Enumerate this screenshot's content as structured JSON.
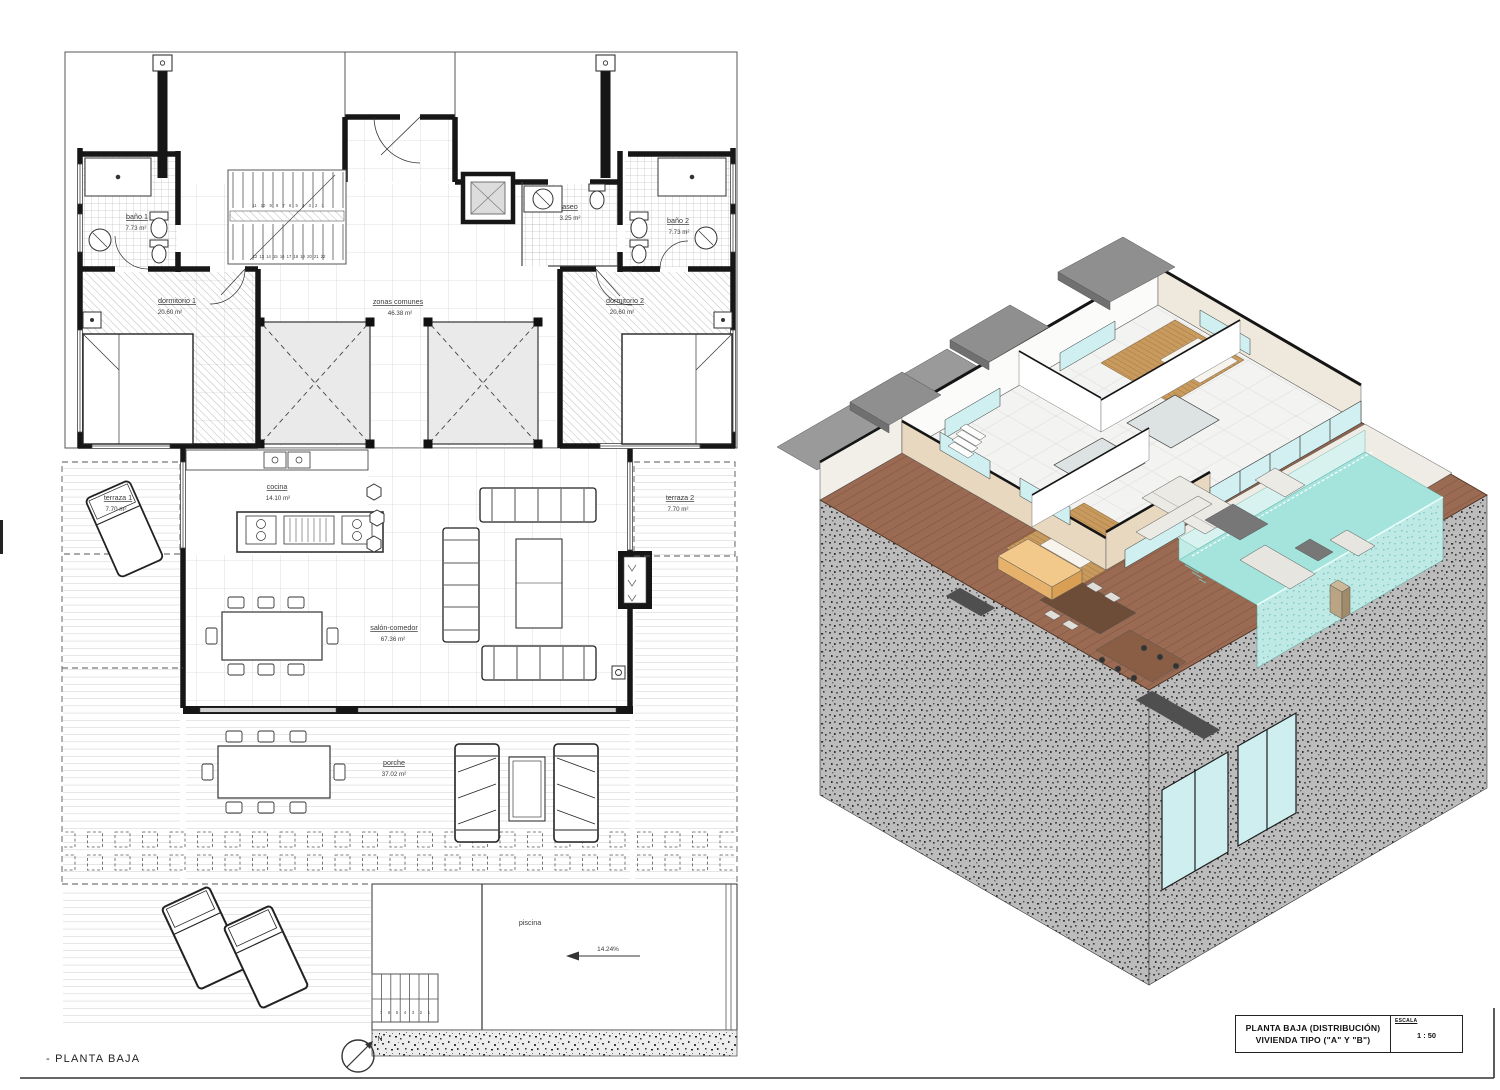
{
  "sheet": {
    "caption": "- PLANTA BAJA",
    "north_label": "N"
  },
  "title_block": {
    "line1": "PLANTA BAJA (DISTRIBUCIÓN)",
    "line2": "VIVIENDA TIPO (\"A\" Y \"B\")",
    "scale_label": "ESCALA",
    "scale_value": "1 : 50"
  },
  "rooms": {
    "bano1": {
      "name": "baño 1",
      "area": "7.73 m²"
    },
    "aseo": {
      "name": "aseo",
      "area": "3.25 m²"
    },
    "bano2": {
      "name": "baño 2",
      "area": "7.73 m²"
    },
    "dormitorio1": {
      "name": "dormitorio 1",
      "area": "20.60 m²"
    },
    "zonas_comunes": {
      "name": "zonas comunes",
      "area": "46.38 m²"
    },
    "dormitorio2": {
      "name": "dormitorio 2",
      "area": "20.60 m²"
    },
    "terraza1": {
      "name": "terraza 1",
      "area": "7.70 m²"
    },
    "cocina": {
      "name": "cocina",
      "area": "14.10 m²"
    },
    "terraza2": {
      "name": "terraza 2",
      "area": "7.70 m²"
    },
    "salon_comedor": {
      "name": "salón-comedor",
      "area": "67.36 m²"
    },
    "porche": {
      "name": "porche",
      "area": "37.02 m²"
    },
    "piscina": {
      "name": "piscina",
      "area": ""
    }
  },
  "annotations": {
    "pool_slope": "14.24%",
    "stairs_upper": "11 10 9 8 7 6 5 4 3 2 1",
    "stairs_lower": "12 13 14 15 16 17 18 19 20 21 22",
    "pool_steps": "7 6 5 4 3 2 1"
  },
  "colors": {
    "deck": "#9a6a52",
    "pool": "#a5e4dc",
    "roof": "#8f8f8f",
    "wall_cream": "#e9d8c0",
    "bedroom_floor": "#c89a5e"
  }
}
